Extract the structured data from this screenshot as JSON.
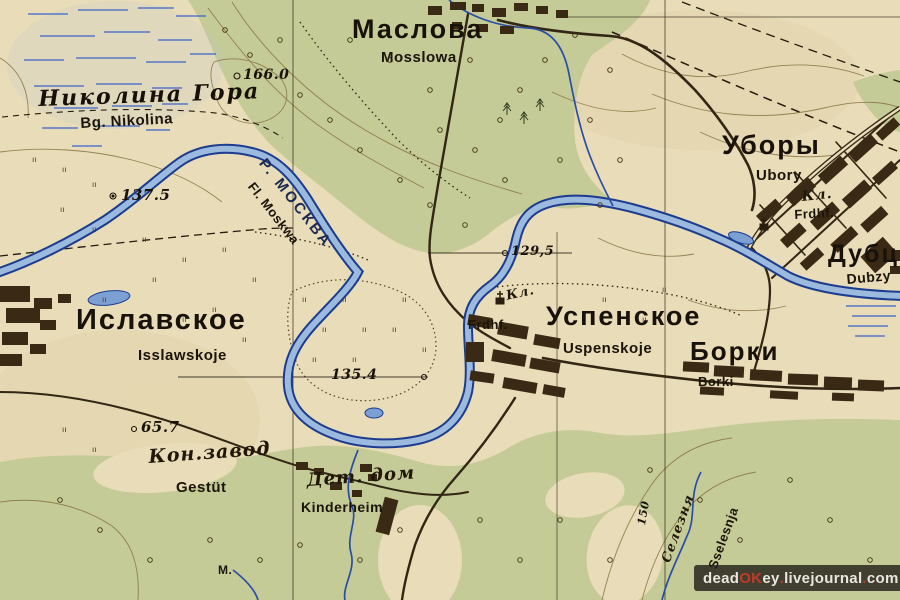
{
  "map_labels": [
    {
      "name": "label-maslova",
      "text": "Маслова",
      "style": "cyr",
      "x": 352,
      "y": 16,
      "size": 27,
      "rot": 0
    },
    {
      "name": "label-maslova-latin",
      "text": "Mosslowa",
      "style": "lat",
      "x": 381,
      "y": 50,
      "size": 15,
      "rot": 0
    },
    {
      "name": "label-nikolina-gora",
      "text": "Николина Гора",
      "style": "serifit",
      "x": 38,
      "y": 88,
      "size": 22,
      "rot": -2
    },
    {
      "name": "label-nikolina-latin",
      "text": "Bg. Nikolina",
      "style": "lat",
      "x": 80,
      "y": 116,
      "size": 15,
      "rot": -3
    },
    {
      "name": "label-ubory",
      "text": "Уборы",
      "style": "cyr",
      "x": 722,
      "y": 132,
      "size": 27,
      "rot": 0
    },
    {
      "name": "label-ubory-latin",
      "text": "Ubory",
      "style": "lat",
      "x": 756,
      "y": 168,
      "size": 15,
      "rot": 0
    },
    {
      "name": "label-ubory-kl",
      "text": "Кл.",
      "style": "cursive",
      "x": 801,
      "y": 190,
      "size": 14,
      "rot": -6
    },
    {
      "name": "label-ubory-frdhf",
      "text": "Frdhf.",
      "style": "lat",
      "x": 794,
      "y": 208,
      "size": 13,
      "rot": -3
    },
    {
      "name": "label-dubzy",
      "text": "Дубцы",
      "style": "cyr",
      "x": 828,
      "y": 242,
      "size": 25,
      "rot": 0
    },
    {
      "name": "label-dubzy-latin",
      "text": "Dubzy",
      "style": "lat",
      "x": 846,
      "y": 272,
      "size": 14,
      "rot": -5
    },
    {
      "name": "label-uspenskoje",
      "text": "Успенское",
      "style": "cyr",
      "x": 546,
      "y": 303,
      "size": 27,
      "rot": 0
    },
    {
      "name": "label-uspenskoje-latin",
      "text": "Uspenskoje",
      "style": "lat",
      "x": 563,
      "y": 341,
      "size": 15,
      "rot": 0
    },
    {
      "name": "label-uspenskoje-kl",
      "text": "Кл.",
      "style": "cursive",
      "x": 505,
      "y": 290,
      "size": 13,
      "rot": -12
    },
    {
      "name": "label-uspenskoje-frdhf",
      "text": "Frdhf.",
      "style": "lat",
      "x": 468,
      "y": 318,
      "size": 13,
      "rot": 0
    },
    {
      "name": "label-islavskoje",
      "text": "Иславское",
      "style": "cyr",
      "x": 76,
      "y": 306,
      "size": 29,
      "rot": 0
    },
    {
      "name": "label-islavskoje-latin",
      "text": "Isslawskoje",
      "style": "lat",
      "x": 138,
      "y": 348,
      "size": 15,
      "rot": 0
    },
    {
      "name": "label-borki",
      "text": "Борки",
      "style": "cyr",
      "x": 690,
      "y": 338,
      "size": 26,
      "rot": 0
    },
    {
      "name": "label-borki-latin",
      "text": "Borki",
      "style": "lat",
      "x": 698,
      "y": 375,
      "size": 13,
      "rot": 0
    },
    {
      "name": "label-kon-zavod",
      "text": "Кон.завод",
      "style": "cursive",
      "x": 148,
      "y": 448,
      "size": 19,
      "rot": -4
    },
    {
      "name": "label-gestuet",
      "text": "Gestüt",
      "style": "lat",
      "x": 176,
      "y": 480,
      "size": 15,
      "rot": 0
    },
    {
      "name": "label-det-dom",
      "text": "Дет. дом",
      "style": "cursive",
      "x": 306,
      "y": 472,
      "size": 18,
      "rot": -4
    },
    {
      "name": "label-kinderheim",
      "text": "Kinderheim",
      "style": "lat",
      "x": 301,
      "y": 500,
      "size": 14,
      "rot": 0
    },
    {
      "name": "label-r-moskva",
      "text": "Р. МОСКВА",
      "style": "river",
      "x": 268,
      "y": 156,
      "size": 15,
      "rot": 52
    },
    {
      "name": "label-fl-moskwa",
      "text": "Fl. Moskwa",
      "style": "lat",
      "x": 256,
      "y": 180,
      "size": 13,
      "rot": 52
    },
    {
      "name": "label-height-166",
      "text": "166.0",
      "style": "elev",
      "x": 243,
      "y": 68,
      "size": 14,
      "rot": 0
    },
    {
      "name": "label-height-137",
      "text": "137.5",
      "style": "elev",
      "x": 121,
      "y": 188,
      "size": 15,
      "rot": 0
    },
    {
      "name": "label-height-129",
      "text": "129,5",
      "style": "elev",
      "x": 511,
      "y": 245,
      "size": 13,
      "rot": 0
    },
    {
      "name": "label-height-135",
      "text": "135.4",
      "style": "elev",
      "x": 331,
      "y": 368,
      "size": 14,
      "rot": 0
    },
    {
      "name": "label-height-65",
      "text": "65.7",
      "style": "elev",
      "x": 141,
      "y": 420,
      "size": 15,
      "rot": 0
    },
    {
      "name": "label-contour-150",
      "text": "150",
      "style": "elev",
      "x": 636,
      "y": 524,
      "size": 11,
      "rot": -80
    },
    {
      "name": "label-sselesnja",
      "text": "Селезня",
      "style": "cursive",
      "x": 660,
      "y": 560,
      "size": 13,
      "rot": -70
    },
    {
      "name": "label-sselesnja-latin",
      "text": "Sselesnja",
      "style": "lat",
      "x": 706,
      "y": 566,
      "size": 13,
      "rot": -70
    },
    {
      "name": "label-m",
      "text": "М.",
      "style": "lat",
      "x": 218,
      "y": 564,
      "size": 12,
      "rot": 0
    }
  ],
  "watermark": {
    "segments": [
      {
        "text": "dead",
        "color": "#e9e7e0"
      },
      {
        "text": "OK",
        "color": "#c23a2b"
      },
      {
        "text": "ey",
        "color": "#e9e7e0"
      },
      {
        "text": ".",
        "color": "#c23a2b"
      },
      {
        "text": "livejournal",
        "color": "#e9e7e0"
      },
      {
        "text": ".",
        "color": "#c23a2b"
      },
      {
        "text": "com",
        "color": "#e9e7e0"
      }
    ]
  },
  "colors": {
    "paper": "#e9dcb8",
    "forest": "#c5cb97",
    "river_fill": "#9cbade",
    "river_edge": "#1c3c90",
    "marsh_blue": "#3a63cc",
    "road": "#32271    4",
    "building": "#3a2a15",
    "contour": "#8a7847",
    "label_black": "#171106",
    "river_label": "#1d2b52",
    "watermark_red": "#c23a2b"
  }
}
